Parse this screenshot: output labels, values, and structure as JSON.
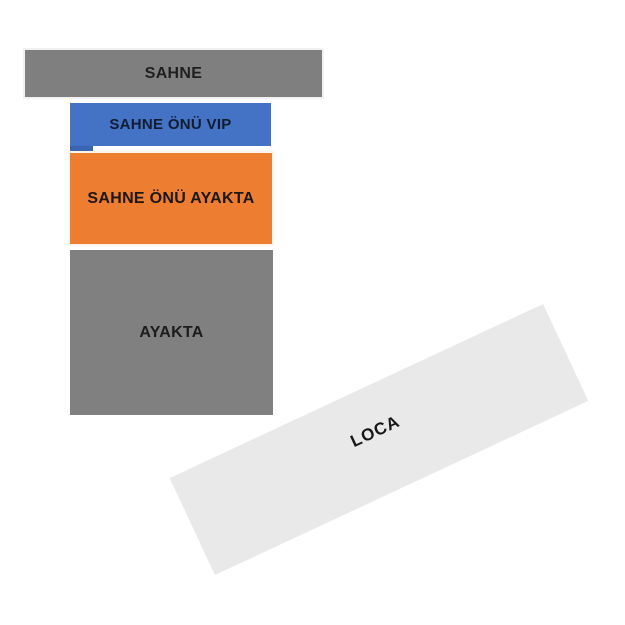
{
  "canvas": {
    "background": "#ffffff"
  },
  "seating_map": {
    "stage": {
      "label": "SAHNE",
      "color": "#7f7f7f",
      "text_color": "#1f1f1f"
    },
    "vip": {
      "label": "SAHNE ÖNÜ VIP",
      "color": "#4472c4",
      "notch_color": "#3d66b0",
      "text_color": "#121c30"
    },
    "front_standing": {
      "label": "SAHNE ÖNÜ AYAKTA",
      "color": "#ed7d31",
      "text_color": "#1c1712"
    },
    "standing": {
      "label": "AYAKTA",
      "color": "#808080",
      "text_color": "#1c1c1c"
    },
    "loca": {
      "label": "LOCA",
      "color": "#e9e9e9",
      "text_color": "#171717"
    }
  }
}
